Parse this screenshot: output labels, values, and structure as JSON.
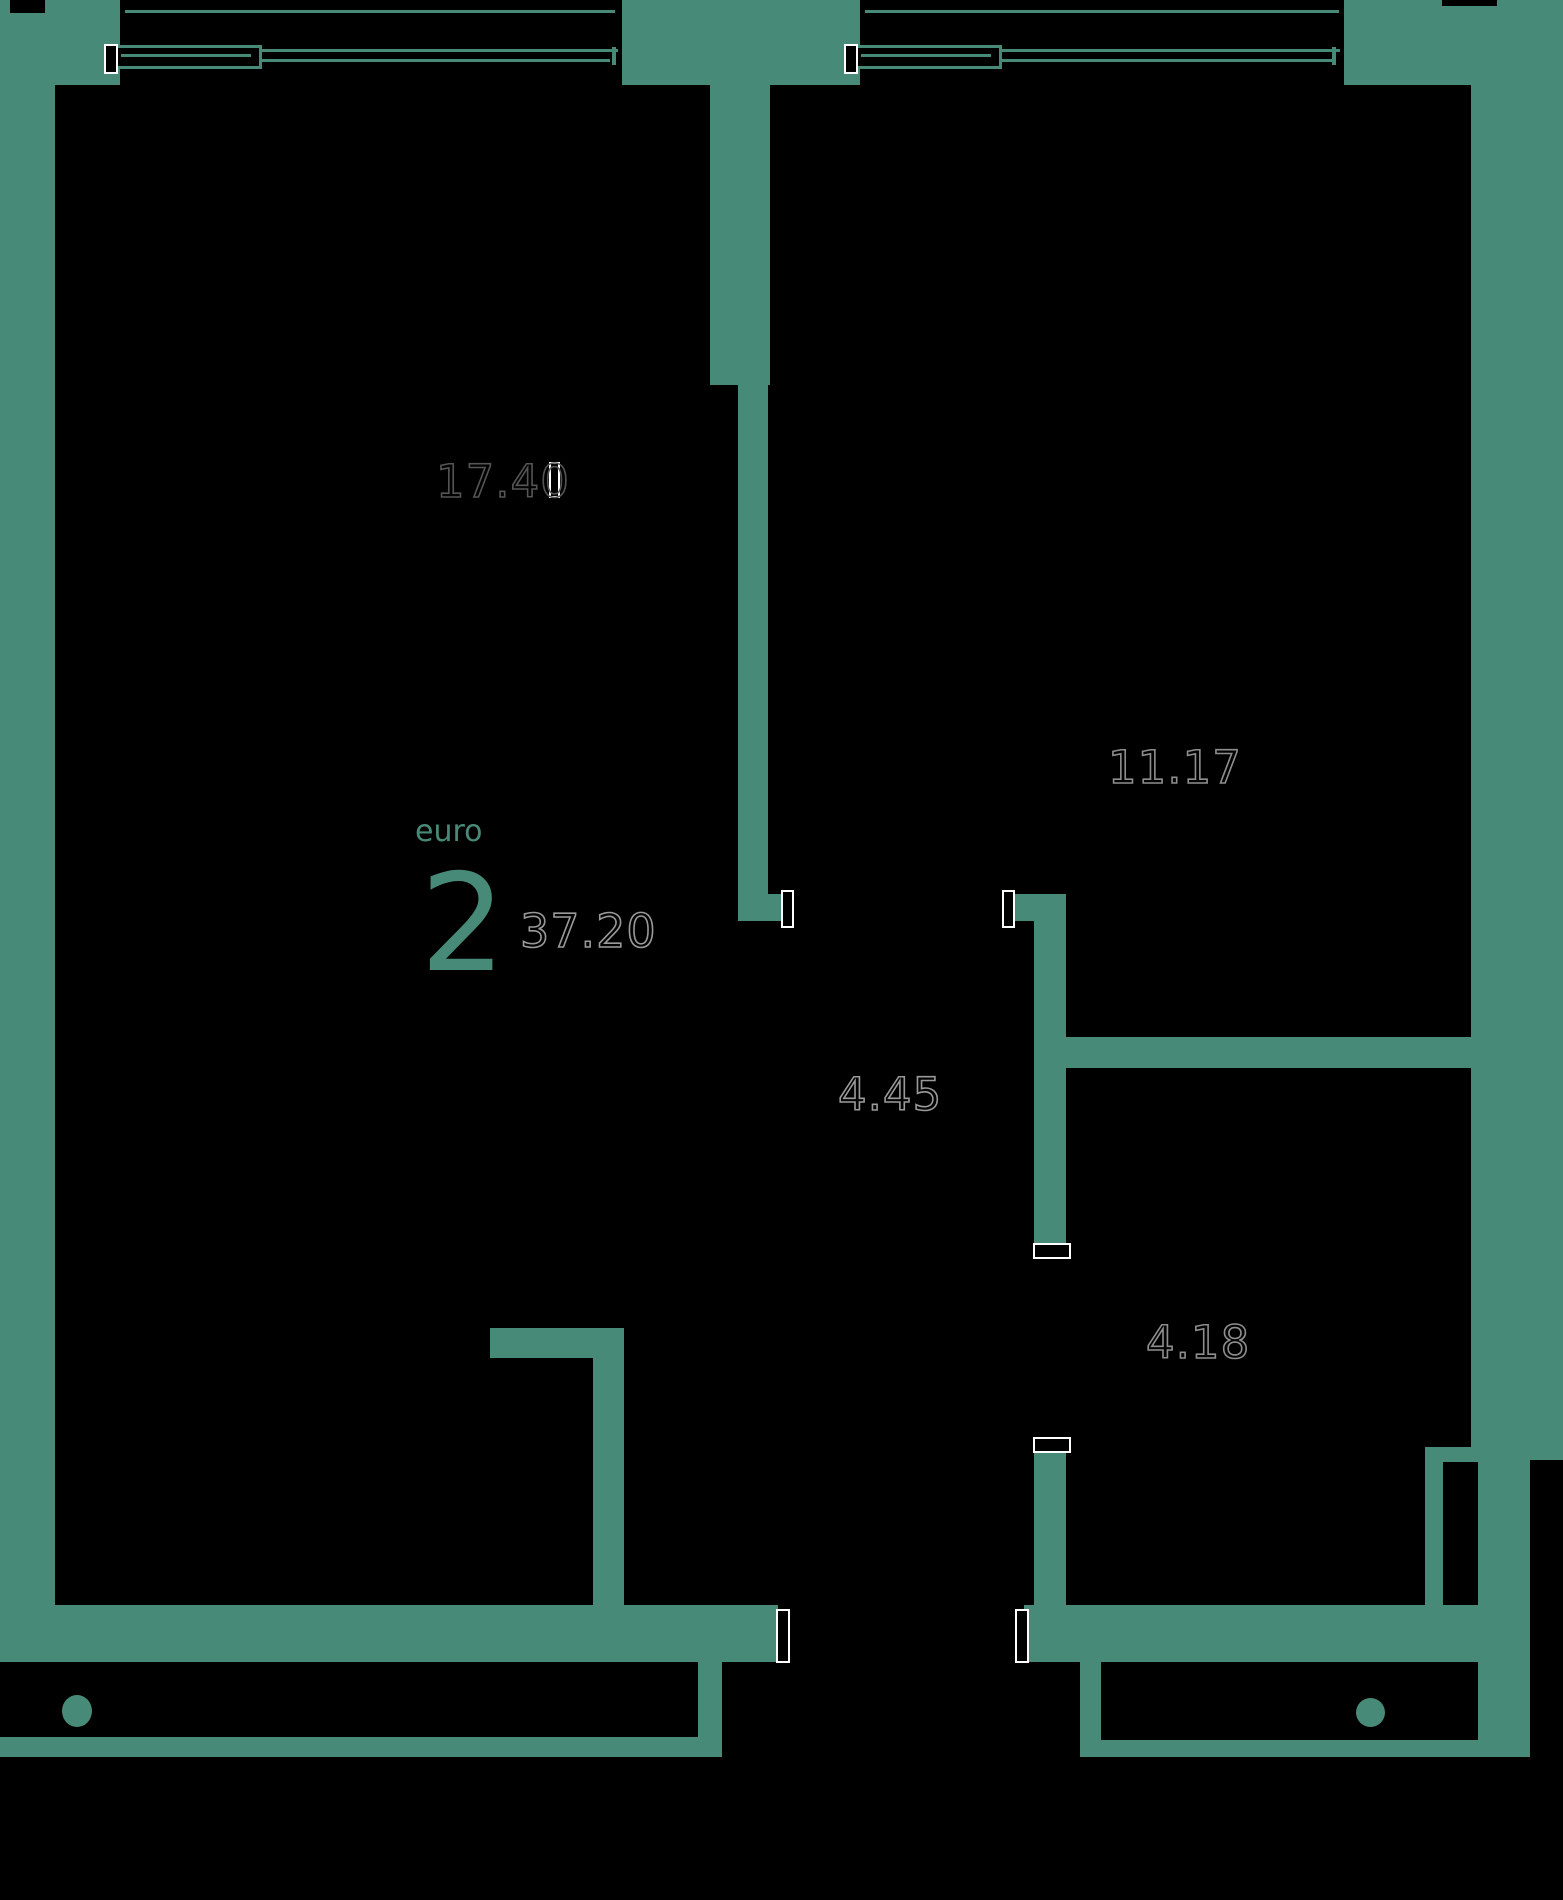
{
  "palette": {
    "wall": "#488a78",
    "background": "#000000",
    "digit_outline": "#8e8e8e",
    "accent_text": "#488a78",
    "marker": "#ffffff"
  },
  "unit": {
    "type_label": "euro",
    "type_number": "2",
    "total_area": "37.20"
  },
  "rooms": [
    {
      "name": "living-room",
      "area": "17.40"
    },
    {
      "name": "bedroom",
      "area": "11.17"
    },
    {
      "name": "hallway",
      "area": "4.45"
    },
    {
      "name": "bathroom",
      "area": "4.18"
    }
  ]
}
